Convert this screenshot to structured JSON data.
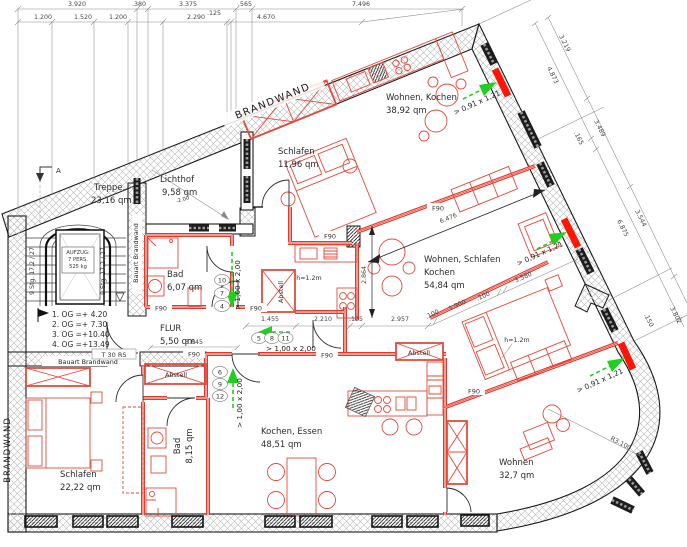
{
  "colors": {
    "wall_red": "#e2392a",
    "window_red": "#ff1505",
    "escape_green": "#21cf21",
    "wall_black": "#1a1a1a",
    "dim_gray": "#8c8c8c"
  },
  "outer_walls": {
    "brandwand_top": "BRANDWAND",
    "brandwand_left": "BRANDWAND"
  },
  "inner_walls": {
    "bauart_vertical": "Bauart Brandwand",
    "bauart_horizontal": "Bauart Brandwand",
    "fire_rating": "F90",
    "fire_door": "T 30 RS"
  },
  "rooms": {
    "treppe": {
      "name": "Treppe,",
      "area": "23,16 qm"
    },
    "lichthof": {
      "name": "Lichthof",
      "area": "9,58 qm"
    },
    "schlafen1": {
      "name": "Schlafen",
      "area": "11,96 qm"
    },
    "wohnen_kochen": {
      "name": "Wohnen, Kochen",
      "area": "38,92 qm"
    },
    "bad1": {
      "name": "Bad",
      "area": "6,07 qm"
    },
    "flur": {
      "name": "FLUR",
      "area": "5,50 qm"
    },
    "wsk": {
      "name1": "Wohnen, Schlafen",
      "name2": "Kochen",
      "area": "54,84 qm"
    },
    "kochen_essen": {
      "name": "Kochen, Essen",
      "area": "48,51 qm"
    },
    "schlafen2": {
      "name": "Schlafen",
      "area": "22,22 qm"
    },
    "bad2": {
      "name": "Bad",
      "area": "8,15 qm"
    },
    "wohnen2": {
      "name": "Wohnen",
      "area": "32,7 qm"
    }
  },
  "stairwell": {
    "flight_label": "9 Stg. 17,2 / 27",
    "elevator": [
      "AUFZUG:",
      "7 PERS.",
      "525 kg"
    ],
    "levels": [
      "1. OG =+  4.20",
      "2. OG =+  7.30",
      "3. OG =+10.40",
      "4. OG =+13.49"
    ],
    "section_marker": "A"
  },
  "annotations": {
    "storage": "Abstell",
    "parapet_height": "h=1.2m",
    "exit_door_size": "> 1,00 x 2,00",
    "exit_window_size": "> 0,91 x 1,21",
    "lichthof_level": "-2.00"
  },
  "step_numbers": {
    "top": [
      "10",
      "7",
      "4"
    ],
    "middle": [
      "5",
      "8",
      "11"
    ],
    "bottom": [
      "6",
      "9",
      "12"
    ]
  },
  "dimensions": {
    "top_row_1": [
      "3.920",
      ".380",
      "3.375",
      ".565",
      "7.496"
    ],
    "top_row_2": [
      "1.200",
      "1.520",
      "1.200",
      "2.290",
      ".125",
      "4.670"
    ],
    "right_outer": [
      "3.219",
      "3.489",
      "3.544",
      "3.802"
    ],
    "right_inner": [
      "4.873",
      ".165",
      "6.875",
      ".150"
    ],
    "horizontal_row": [
      "1.455",
      "2.210",
      ".125",
      "2.957"
    ],
    "diagonal_row": [
      ".100",
      "1.900",
      ".100",
      "3.580"
    ],
    "interior": {
      "living_diag": "6.476",
      "kitchen_depth": "2.864",
      "flur_width": "3.645",
      "radius": "R3.100"
    }
  }
}
